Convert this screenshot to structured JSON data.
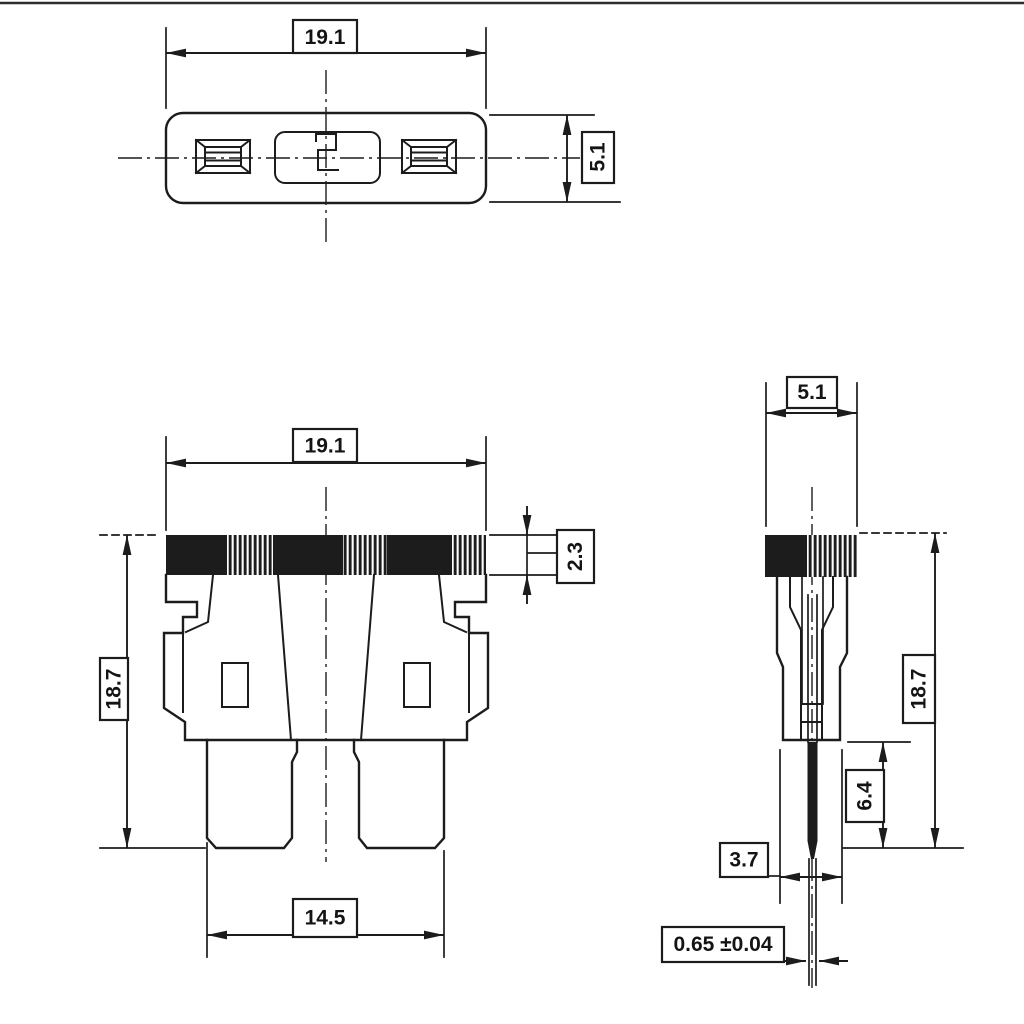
{
  "drawing": {
    "kind": "technical-dimension-drawing",
    "component": "automotive-blade-fuse",
    "background_color": "#ffffff",
    "line_color": "#1c1c1c",
    "views": {
      "top_view": {
        "dim_body_length": "19.1",
        "dim_body_width": "5.1"
      },
      "front_view": {
        "dim_body_length": "19.1",
        "dim_cap_height": "2.3",
        "dim_overall_height": "18.7",
        "dim_terminal_span": "14.5"
      },
      "side_view": {
        "dim_body_width": "5.1",
        "dim_overall_height": "18.7",
        "dim_terminal_length": "6.4",
        "dim_lower_body_width": "3.7",
        "dim_terminal_thickness": "0.65 ±0.04"
      }
    }
  }
}
